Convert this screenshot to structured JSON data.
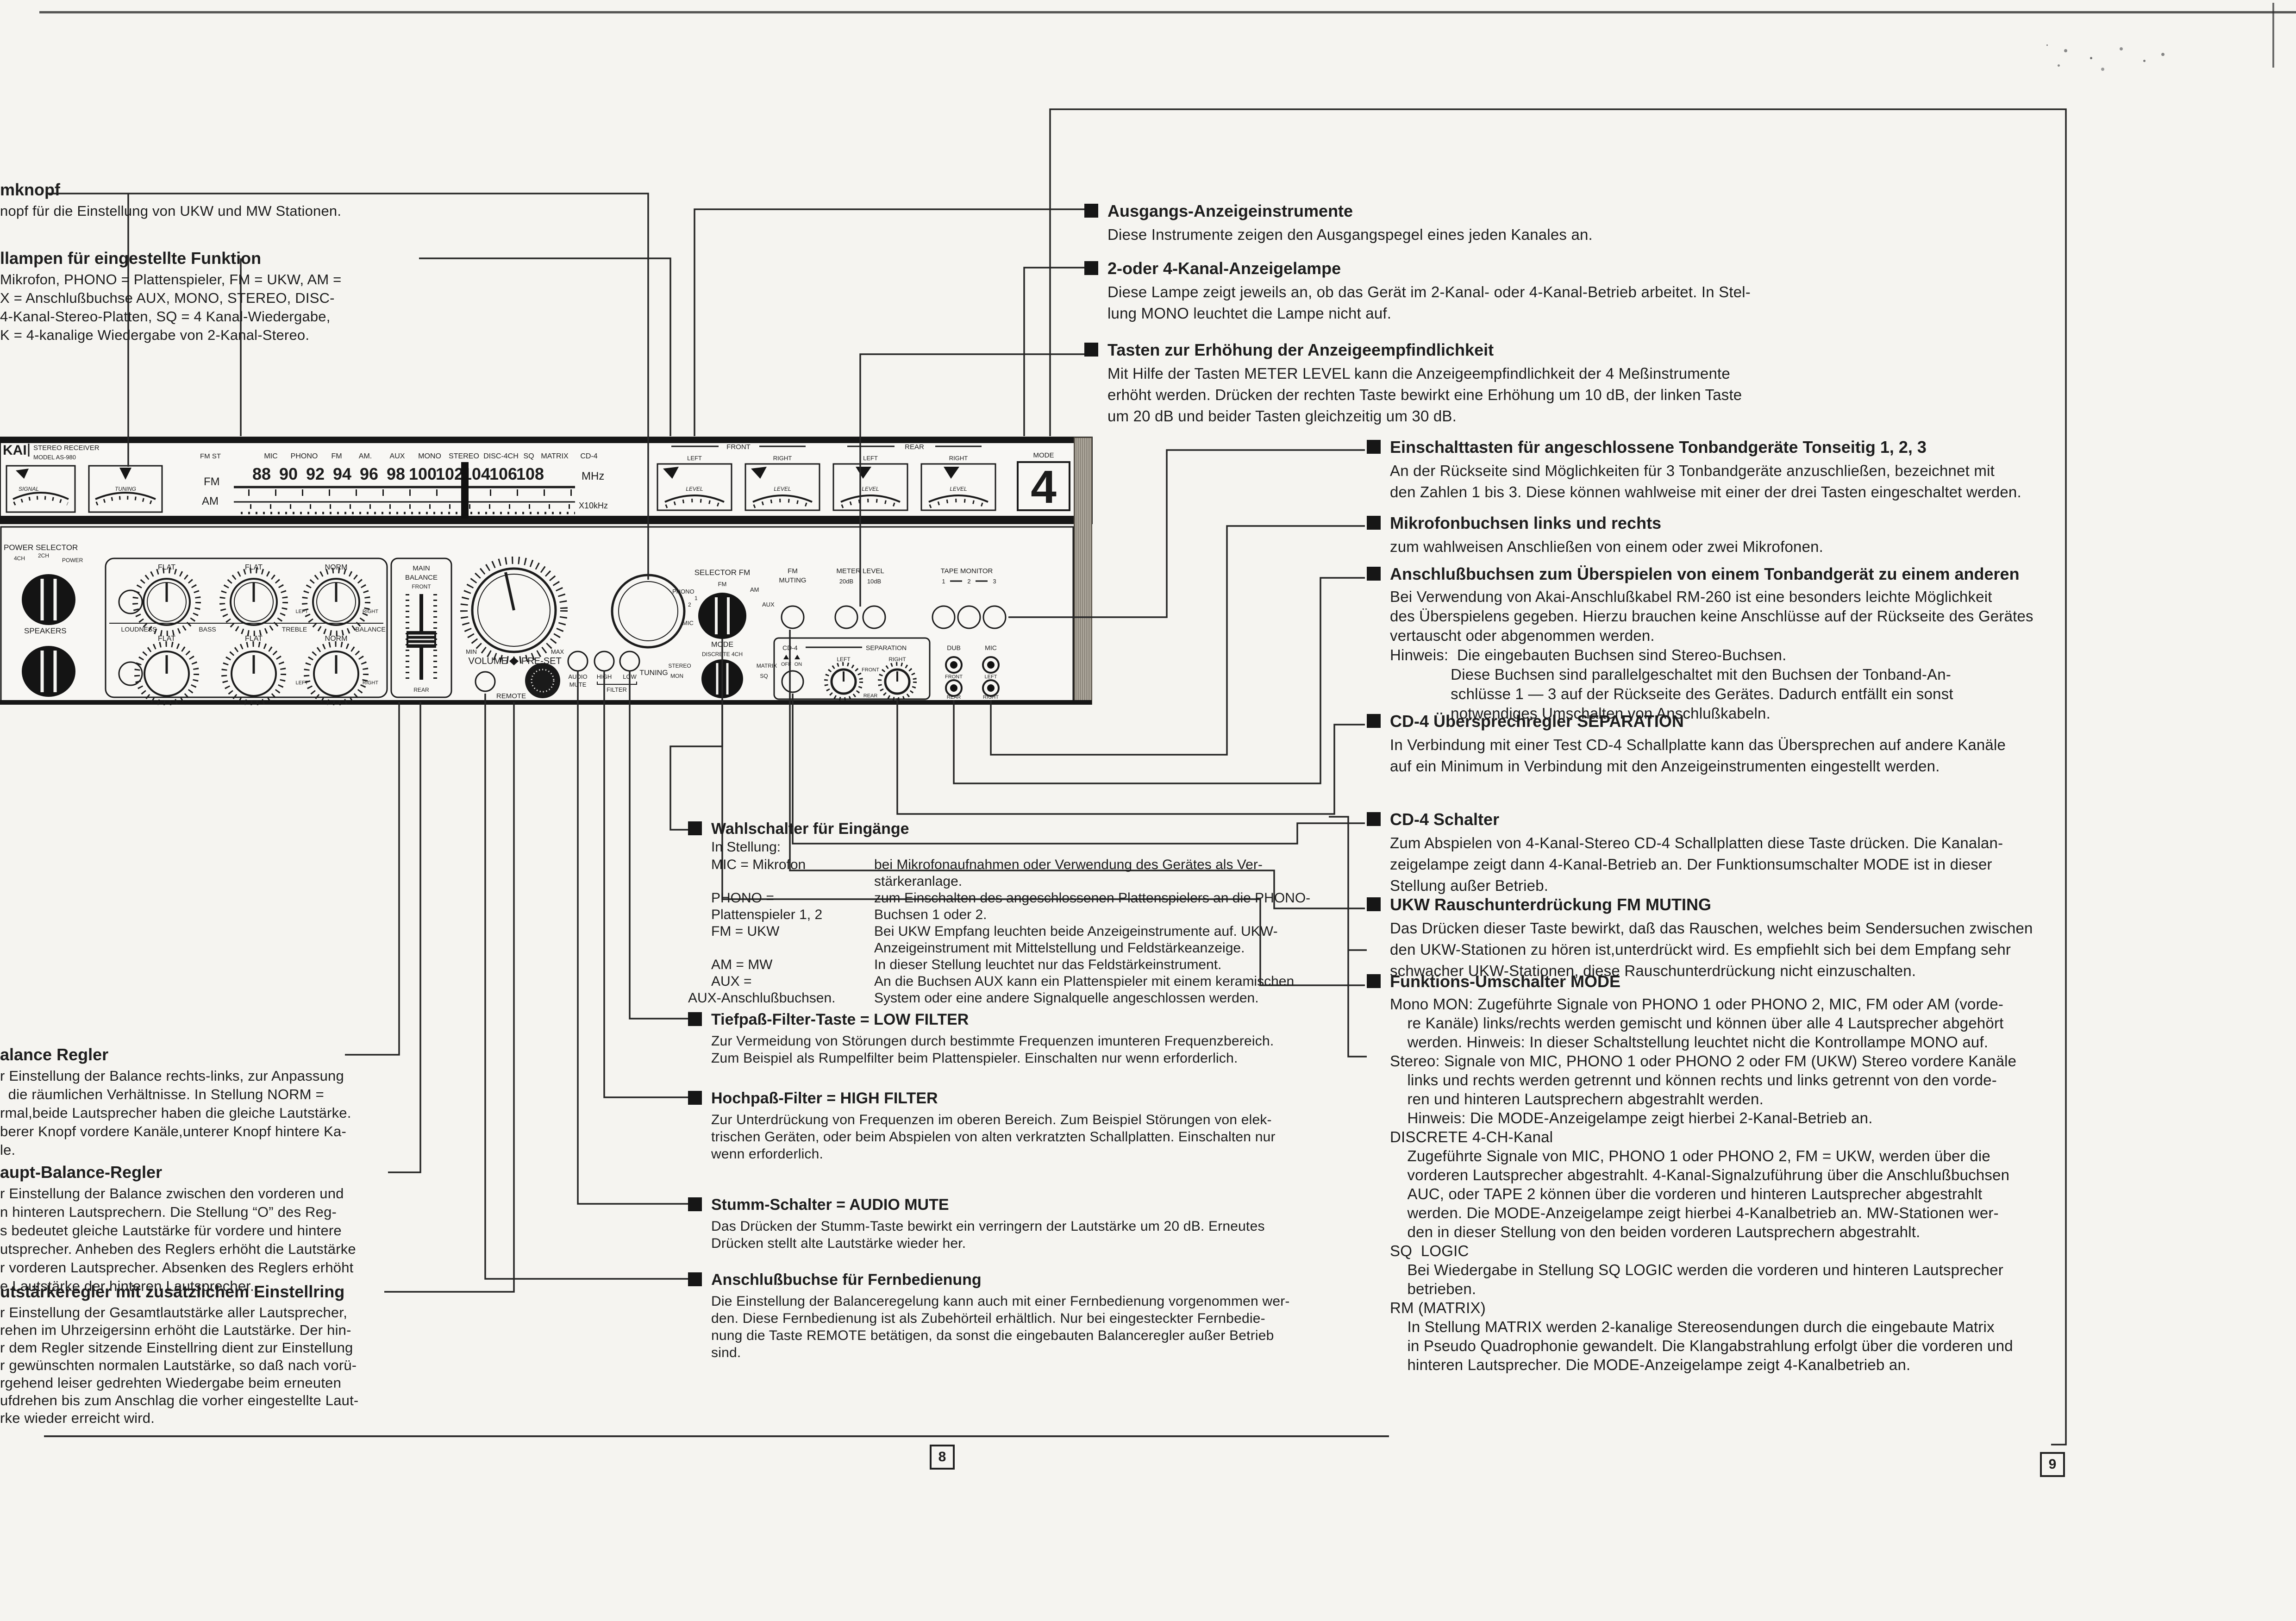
{
  "page": {
    "left_number": "8",
    "right_number": "9"
  },
  "device": {
    "brand": {
      "l1": "KAI",
      "l2": "STEREO RECEIVER",
      "l3": "MODEL AS-980"
    },
    "meters": {
      "signal": "SIGNAL",
      "tuning": "TUNING"
    },
    "fmst": "FM ST",
    "fm": "FM",
    "am": "AM",
    "functions": [
      "MIC",
      "PHONO",
      "FM",
      "AM.",
      "AUX",
      "MONO",
      "STEREO",
      "DISC-4CH",
      "SQ",
      "MATRIX",
      "CD-4"
    ],
    "dial": [
      "88",
      "90",
      "92",
      "94",
      "96",
      "98",
      "100",
      "102",
      "104",
      "106",
      "108"
    ],
    "mhz": "MHz",
    "x10khz": "X10kHz",
    "vu": {
      "front": "FRONT",
      "rear": "REAR",
      "left": "LEFT",
      "right": "RIGHT",
      "level": "LEVEL"
    },
    "mode_display": {
      "label": "MODE",
      "value": "4"
    },
    "power": {
      "title": "POWER SELECTOR",
      "p1": "4CH",
      "p2": "2CH",
      "p3": "POWER",
      "speakers": "SPEAKERS"
    },
    "tone": {
      "loudness": "LOUDNESS",
      "bass": "BASS",
      "treble": "TREBLE",
      "balance": "BALANCE",
      "flat": "FLAT",
      "norm": "NORM",
      "left": "LEFT",
      "right": "RIGHT"
    },
    "main_balance": {
      "l1": "MAIN",
      "l2": "BALANCE",
      "l3": "FRONT",
      "rear": "REAR"
    },
    "volume": {
      "label": "VOLUME",
      "preset": "PRE-SET",
      "min": "MIN",
      "max": "MAX",
      "remote": "REMOTE"
    },
    "tuning_label": "TUNING",
    "selector": {
      "title": "SELECTOR FM",
      "fm": "FM",
      "am": "AM",
      "aux": "AUX",
      "phono": "PHONO",
      "n1": "1",
      "n2": "2",
      "mic": "MIC"
    },
    "mode_knob": {
      "title": "MODE",
      "discrete": "DISCRETE 4CH",
      "stereo": "STEREO",
      "mon": "MON",
      "matrix": "MATRIX",
      "sq": "SQ"
    },
    "fm_muting": {
      "l1": "FM",
      "l2": "MUTING"
    },
    "meter_level": {
      "title": "METER LEVEL",
      "db20": "20dB",
      "db10": "10dB"
    },
    "tape_monitor": {
      "title": "TAPE MONITOR",
      "n1": "1",
      "n2": "2",
      "n3": "3"
    },
    "cd4": {
      "cd4": "CD-4",
      "separation": "SEPARATION",
      "off": "OFF",
      "on": "ON",
      "left": "LEFT",
      "right": "RIGHT",
      "front": "FRONT",
      "rear": "REAR"
    },
    "jacks": {
      "dub": "DUB",
      "mic": "MIC",
      "front": "FRONT",
      "rear": "REAR",
      "left": "LEFT",
      "right": "RIGHT"
    },
    "filters": {
      "audio": "AUDIO",
      "mute": "MUTE",
      "high": "HIGH",
      "low": "LOW",
      "filter": "FILTER"
    }
  },
  "left_col": {
    "b1": {
      "heading": "mknopf",
      "lines": [
        "nopf für die Einstellung von UKW und MW Stationen."
      ]
    },
    "b2": {
      "heading": "llampen für eingestellte Funktion",
      "lines": [
        "Mikrofon, PHONO = Plattenspieler, FM = UKW, AM =",
        "X = Anschlußbuchse AUX, MONO, STEREO, DISC-",
        "4-Kanal-Stereo-Platten, SQ = 4 Kanal-Wiedergabe,",
        "K = 4-kanalige Wiedergabe von 2-Kanal-Stereo."
      ]
    },
    "b3": {
      "heading": "alance Regler",
      "lines": [
        "r Einstellung der Balance rechts-links, zur Anpassung",
        "  die räumlichen Verhältnisse. In Stellung NORM =",
        "rmal,beide Lautsprecher haben die gleiche Lautstärke.",
        "berer Knopf vordere Kanäle,unterer Knopf hintere Ka-",
        "le."
      ]
    },
    "b4": {
      "heading": "aupt-Balance-Regler",
      "lines": [
        "r Einstellung der Balance zwischen den vorderen und",
        "n hinteren Lautsprechern. Die Stellung “O” des Reg-",
        "s bedeutet gleiche Lautstärke für vordere und hintere",
        "utsprecher. Anheben des Reglers erhöht die Lautstärke",
        "r vorderen Lautsprecher. Absenken des Reglers erhöht",
        "e Lautstärke der hinteren Lautsprecher."
      ]
    },
    "b5": {
      "heading": "utstärkeregler mit zusätzlichem Einstellring",
      "lines": [
        "r Einstellung der Gesamtlautstärke aller Lautsprecher,",
        "rehen im Uhrzeigersinn erhöht die Lautstärke. Der hin-",
        "r dem Regler sitzende Einstellring dient zur Einstellung",
        "r gewünschten normalen Lautstärke, so daß nach vorü-",
        "rgehend leiser gedrehten Wiedergabe beim erneuten",
        "ufdrehen bis zum Anschlag die vorher eingestellte Laut-",
        "rke wieder erreicht wird."
      ]
    }
  },
  "mid_col": {
    "selector": {
      "heading": "Wahlschalter für Eingänge",
      "intro": "In Stellung:",
      "rows": [
        {
          "term": "MIC = Mikrofon",
          "def": "bei Mikrofonaufnahmen oder Verwendung des Gerätes als Ver-\nstärkeranlage."
        },
        {
          "term": "PHONO =\nPlattenspieler 1, 2",
          "def": "zum Einschalten des angeschlossenen Plattenspielers an die PHONO-\nBuchsen 1 oder 2."
        },
        {
          "term": "FM = UKW",
          "def": "Bei UKW Empfang leuchten beide Anzeigeinstrumente auf. UKW-\nAnzeigeinstrument mit Mittelstellung und Feldstärkeanzeige."
        },
        {
          "term": "AM = MW",
          "def": "In dieser Stellung leuchtet nur das Feldstärkeinstrument."
        },
        {
          "term": "AUX =",
          "def": "An die Buchsen AUX kann ein Plattenspieler mit einem keramischen"
        },
        {
          "term": "AUX-Anschlußbuchsen.",
          "def": "System oder eine andere Signalquelle angeschlossen werden."
        }
      ]
    },
    "low_filter": {
      "heading": "Tiefpaß-Filter-Taste = LOW FILTER",
      "lines": [
        "Zur Vermeidung von Störungen durch bestimmte Frequenzen imunteren Frequenzbereich.",
        "Zum Beispiel als Rumpelfilter beim Plattenspieler. Einschalten nur wenn erforderlich."
      ]
    },
    "high_filter": {
      "heading": "Hochpaß-Filter = HIGH FILTER",
      "lines": [
        "Zur Unterdrückung von Frequenzen im oberen Bereich. Zum Beispiel Störungen von elek-",
        "trischen Geräten, oder beim Abspielen von alten verkratzten Schallplatten. Einschalten nur",
        "wenn erforderlich."
      ]
    },
    "audio_mute": {
      "heading": "Stumm-Schalter = AUDIO MUTE",
      "lines": [
        "Das Drücken der Stumm-Taste bewirkt ein verringern der Lautstärke um 20 dB. Erneutes",
        "Drücken stellt alte Lautstärke wieder her."
      ]
    },
    "remote": {
      "heading": "Anschlußbuchse für Fernbedienung",
      "lines": [
        "Die Einstellung der Balanceregelung kann auch mit einer Fernbedienung vorgenommen wer-",
        "den. Diese Fernbedienung ist als Zubehörteil erhältlich. Nur bei eingesteckter Fernbedie-",
        "nung die Taste REMOTE betätigen, da sonst die eingebauten Balanceregler außer Betrieb",
        "sind."
      ]
    }
  },
  "right_col": {
    "b1": {
      "heading": "Ausgangs-Anzeigeinstrumente",
      "lines": [
        "Diese Instrumente zeigen den Ausgangspegel eines jeden Kanales an."
      ]
    },
    "b2": {
      "heading": "2-oder 4-Kanal-Anzeigelampe",
      "lines": [
        "Diese Lampe zeigt jeweils an, ob das Gerät im 2-Kanal- oder 4-Kanal-Betrieb arbeitet. In Stel-",
        "lung MONO leuchtet die Lampe nicht auf."
      ]
    },
    "b3": {
      "heading": "Tasten zur Erhöhung der Anzeigeempfindlichkeit",
      "lines": [
        "Mit Hilfe der Tasten METER LEVEL kann die Anzeigeempfindlichkeit der 4 Meßinstrumente",
        "erhöht werden. Drücken der rechten Taste bewirkt eine Erhöhung um 10 dB, der linken Taste",
        "um 20 dB und beider Tasten gleichzeitig um 30 dB."
      ]
    },
    "b4": {
      "heading": "Einschalttasten für angeschlossene Tonbandgeräte Tonseitig 1, 2, 3",
      "lines": [
        "An der Rückseite sind Möglichkeiten für 3 Tonbandgeräte anzuschließen, bezeichnet mit",
        "den Zahlen 1 bis 3. Diese können wahlweise mit einer der drei Tasten eingeschaltet werden."
      ]
    },
    "b5": {
      "heading": "Mikrofonbuchsen links und rechts",
      "lines": [
        "zum wahlweisen Anschließen von einem oder zwei Mikrofonen."
      ]
    },
    "b6": {
      "heading": "Anschlußbuchsen zum Überspielen von einem Tonbandgerät zu einem anderen",
      "lines": [
        "Bei Verwendung von Akai-Anschlußkabel RM-260 ist eine besonders leichte Möglichkeit",
        "des Überspielens gegeben. Hierzu brauchen keine Anschlüsse auf der Rückseite des Gerätes",
        "vertauscht oder abgenommen werden.",
        "Hinweis:  Die eingebauten Buchsen sind Stereo-Buchsen.",
        "              Diese Buchsen sind parallelgeschaltet mit den Buchsen der Tonband-An-",
        "              schlüsse 1 — 3 auf der Rückseite des Gerätes. Dadurch entfällt ein sonst",
        "              notwendiges Umschalten von Anschlußkabeln."
      ]
    },
    "b7": {
      "heading": "CD-4 Übersprechregler SEPARATION",
      "lines": [
        "In Verbindung mit einer Test CD-4 Schallplatte kann das Übersprechen auf andere Kanäle",
        "auf ein Minimum in Verbindung mit den Anzeigeinstrumenten eingestellt werden."
      ]
    },
    "b8": {
      "heading": "CD-4 Schalter",
      "lines": [
        "Zum Abspielen von 4-Kanal-Stereo CD-4 Schallplatten diese Taste drücken. Die Kanalan-",
        "zeigelampe zeigt dann 4-Kanal-Betrieb an. Der Funktionsumschalter MODE ist in dieser",
        "Stellung außer Betrieb."
      ]
    },
    "b9": {
      "heading": "UKW Rauschunterdrückung FM MUTING",
      "lines": [
        "Das Drücken dieser Taste bewirkt, daß das Rauschen, welches beim Sendersuchen zwischen",
        "den UKW-Stationen zu hören ist,unterdrückt wird. Es empfiehlt sich bei dem Empfang sehr",
        "schwacher UKW-Stationen, diese Rauschunterdrückung nicht einzuschalten."
      ]
    },
    "b10": {
      "heading": "Funktions-Umschalter MODE",
      "lines": [
        "Mono MON: Zugeführte Signale von PHONO 1 oder PHONO 2, MIC, FM oder AM (vorde-",
        "    re Kanäle) links/rechts werden gemischt und können über alle 4 Lautsprecher abgehört",
        "    werden. Hinweis: In dieser Schaltstellung leuchtet nicht die Kontrollampe MONO auf.",
        "Stereo: Signale von MIC, PHONO 1 oder PHONO 2 oder FM (UKW) Stereo vordere Kanäle",
        "    links und rechts werden getrennt und können rechts und links getrennt von den vorde-",
        "    ren und hinteren Lautsprechern abgestrahlt werden.",
        "    Hinweis: Die MODE-Anzeigelampe zeigt hierbei 2-Kanal-Betrieb an.",
        "DISCRETE 4-CH-Kanal",
        "    Zugeführte Signale von MIC, PHONO 1 oder PHONO 2, FM = UKW, werden über die",
        "    vorderen Lautsprecher abgestrahlt. 4-Kanal-Signalzuführung über die Anschlußbuchsen",
        "    AUC, oder TAPE 2 können über die vorderen und hinteren Lautsprecher abgestrahlt",
        "    werden. Die MODE-Anzeigelampe zeigt hierbei 4-Kanalbetrieb an. MW-Stationen wer-",
        "    den in dieser Stellung von den beiden vorderen Lautsprechern abgestrahlt.",
        "SQ  LOGIC",
        "    Bei Wiedergabe in Stellung SQ LOGIC werden die vorderen und hinteren Lautsprecher",
        "    betrieben.",
        "RM (MATRIX)",
        "    In Stellung MATRIX werden 2-kanalige Stereosendungen durch die eingebaute Matrix",
        "    in Pseudo Quadrophonie gewandelt. Die Klangabstrahlung erfolgt über die vorderen und",
        "    hinteren Lautsprecher. Die MODE-Anzeigelampe zeigt 4-Kanalbetrieb an."
      ]
    }
  }
}
